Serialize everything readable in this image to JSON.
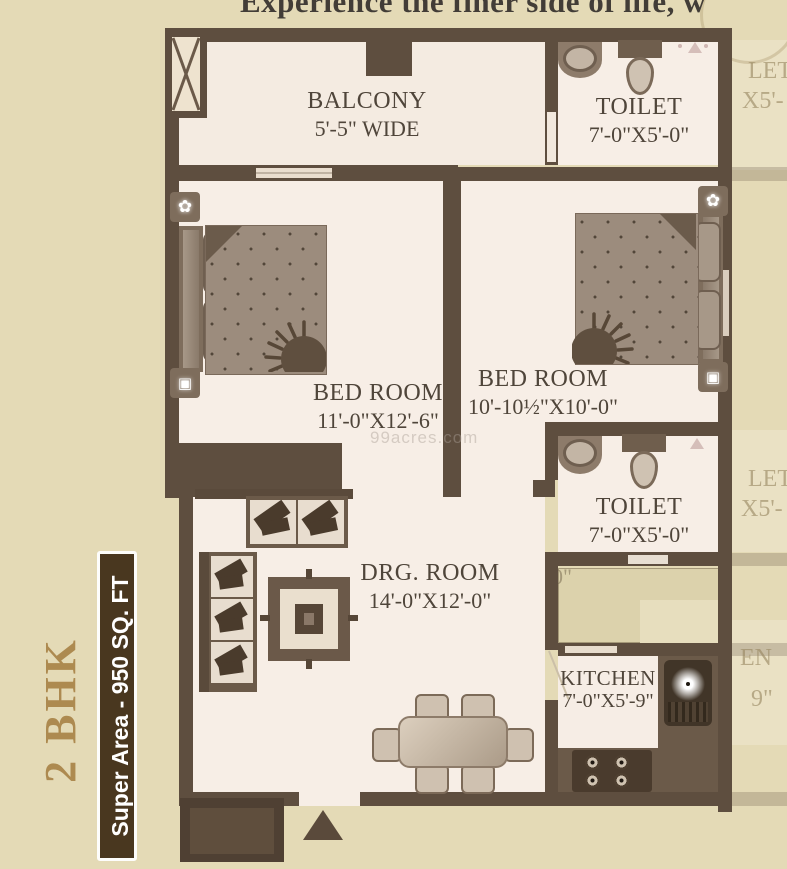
{
  "tagline": "Experience the finer side of life, w",
  "side_panel": {
    "bhk": "2 BHK",
    "super_area": "Super Area - 950 SQ. FT"
  },
  "rooms": {
    "balcony": {
      "name": "BALCONY",
      "dim": "5'-5\" WIDE"
    },
    "toilet_top": {
      "name": "TOILET",
      "dim": "7'-0\"X5'-0\""
    },
    "bedroom_left": {
      "name": "BED ROOM",
      "dim": "11'-0\"X12'-6\""
    },
    "bedroom_right": {
      "name": "BED ROOM",
      "dim": "10'-10½\"X10'-0\""
    },
    "toilet_mid": {
      "name": "TOILET",
      "dim": "7'-0\"X5'-0\""
    },
    "drawing_room": {
      "name": "DRG. ROOM",
      "dim": "14'-0\"X12'-0\""
    },
    "kitchen": {
      "name": "KITCHEN",
      "dim": "7'-0\"X5'-9\""
    }
  },
  "adjacent_plan": {
    "toilet_top_frag1": "LET",
    "toilet_top_frag2": "X5'-",
    "toilet_mid_frag1": "LET",
    "toilet_mid_frag2": "X5'-",
    "kitchen_frag1": "EN",
    "kitchen_frag2": "9\"",
    "corridor_frag": "0\""
  },
  "watermark": "99acres.com",
  "colors": {
    "background": "#e4dab6",
    "wall": "#5e4e3f",
    "room_floor": "#f7eee6",
    "accent_gold": "#ad8a50",
    "super_area_bar": "#49371f",
    "label_text": "#4f453a"
  }
}
